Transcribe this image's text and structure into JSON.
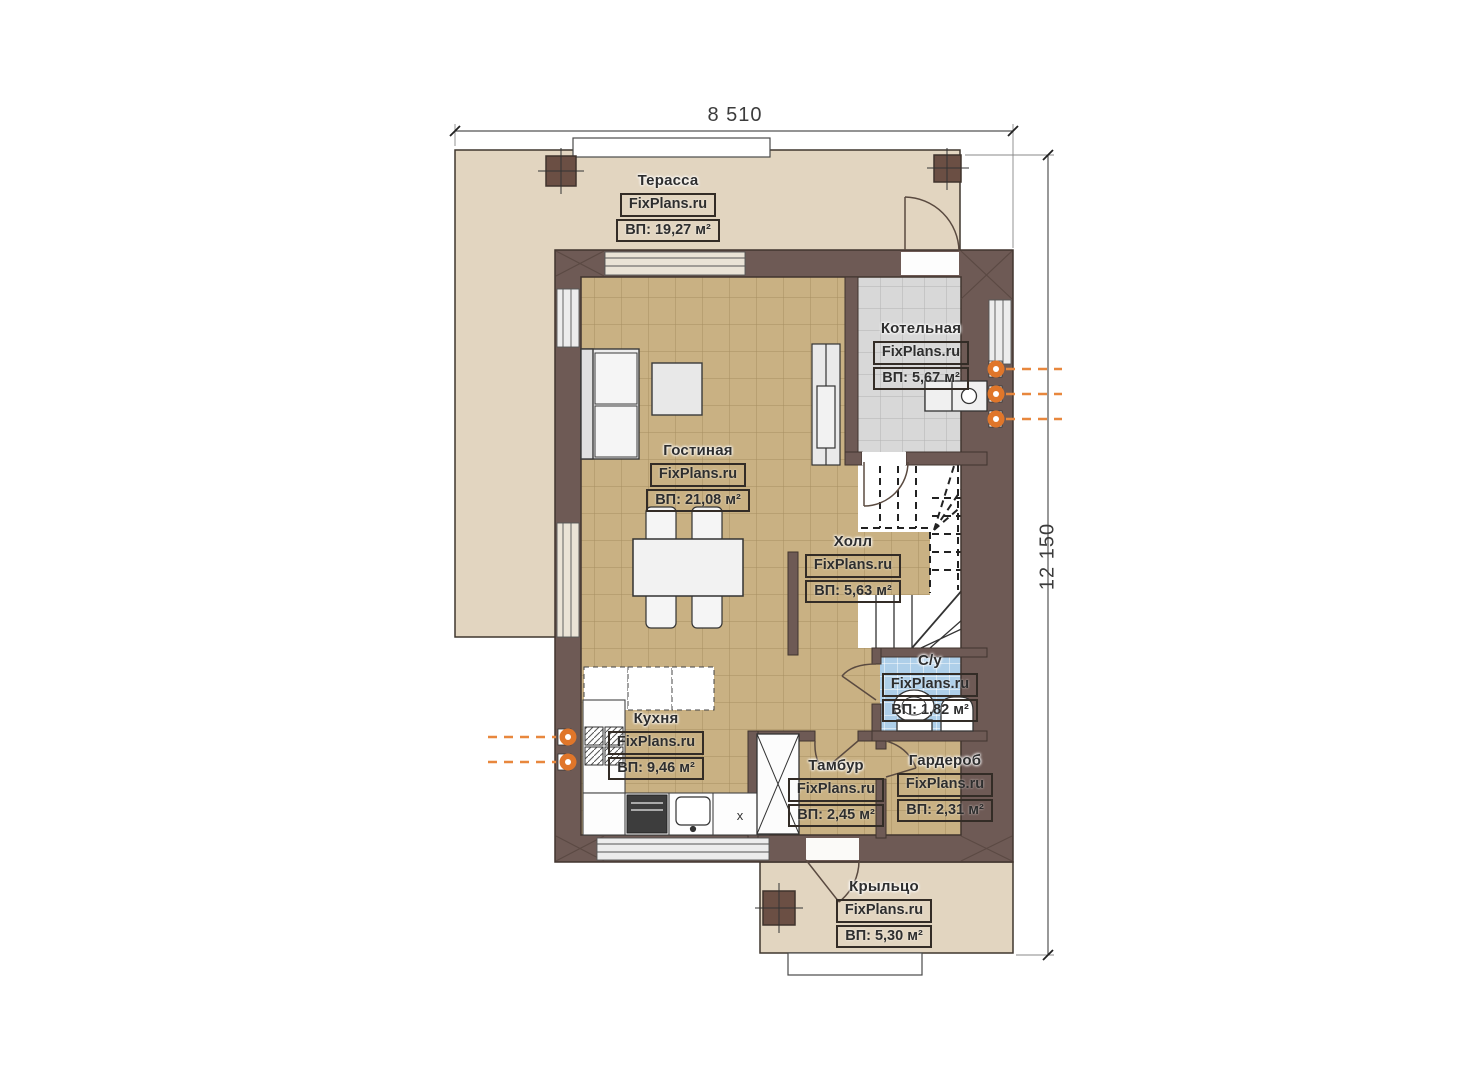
{
  "brand": "FixPlans.ru",
  "dimensions": {
    "width_label": "8 510",
    "height_label": "12 150"
  },
  "rooms": [
    {
      "id": "terrace",
      "name": "Терасса",
      "area": "ВП: 19,27 м²"
    },
    {
      "id": "boiler",
      "name": "Котельная",
      "area": "ВП: 5,67 м²"
    },
    {
      "id": "living",
      "name": "Гостиная",
      "area": "ВП: 21,08 м²"
    },
    {
      "id": "hall",
      "name": "Холл",
      "area": "ВП: 5,63 м²"
    },
    {
      "id": "bathroom",
      "name": "С/у",
      "area": "ВП: 1,82 м²"
    },
    {
      "id": "kitchen",
      "name": "Кухня",
      "area": "ВП: 9,46 м²"
    },
    {
      "id": "vestibule",
      "name": "Тамбур",
      "area": "ВП: 2,45 м²"
    },
    {
      "id": "wardrobe",
      "name": "Гардероб",
      "area": "ВП: 2,31 м²"
    },
    {
      "id": "porch",
      "name": "Крыльцо",
      "area": "ВП: 5,30 м²"
    }
  ],
  "marks": {
    "kitchen_corner": "x"
  },
  "colors": {
    "wall": "#6e5a55",
    "floor_tile": "#c9b183",
    "terrace_floor": "#e2d5c0",
    "boiler_floor": "#d8d8d8",
    "bathroom_floor": "#aecfe9",
    "utility_marker": "#e0762a"
  }
}
